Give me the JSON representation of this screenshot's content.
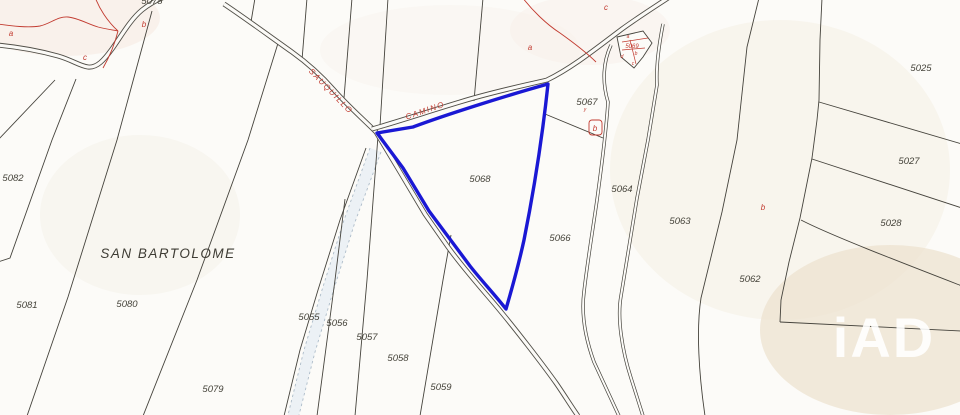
{
  "map": {
    "place_name": "SAN BARTOLOME",
    "watermark": "iAD",
    "roads": [
      {
        "name": "SAUQUILLO"
      },
      {
        "name": "CAMINO"
      }
    ],
    "selected_parcel": {
      "id": "5068",
      "outline_color": "#1a18d4"
    },
    "colors": {
      "background": "#fcfbf8",
      "boundary": "#45433c",
      "road_edge": "#504e47",
      "red_annotation": "#c23b30",
      "stream_fill": "#dfe9f2"
    },
    "parcels": [
      {
        "id": "5078"
      },
      {
        "id": "5082"
      },
      {
        "id": "5081"
      },
      {
        "id": "5080"
      },
      {
        "id": "5079"
      },
      {
        "id": "5055"
      },
      {
        "id": "5056"
      },
      {
        "id": "5057"
      },
      {
        "id": "5058"
      },
      {
        "id": "5059"
      },
      {
        "id": "5068"
      },
      {
        "id": "5067"
      },
      {
        "id": "5066"
      },
      {
        "id": "5064"
      },
      {
        "id": "5063"
      },
      {
        "id": "5062"
      },
      {
        "id": "5025"
      },
      {
        "id": "5027"
      },
      {
        "id": "5028"
      }
    ],
    "red_marks": [
      {
        "letter": "a"
      },
      {
        "letter": "b"
      },
      {
        "letter": "c"
      },
      {
        "letter": "a"
      },
      {
        "letter": "c"
      },
      {
        "letter": "b"
      },
      {
        "letter": "b"
      },
      {
        "letter": "y"
      }
    ],
    "building_parcel": {
      "id": "5069",
      "letters": [
        "a",
        "d",
        "b",
        "c"
      ]
    }
  }
}
